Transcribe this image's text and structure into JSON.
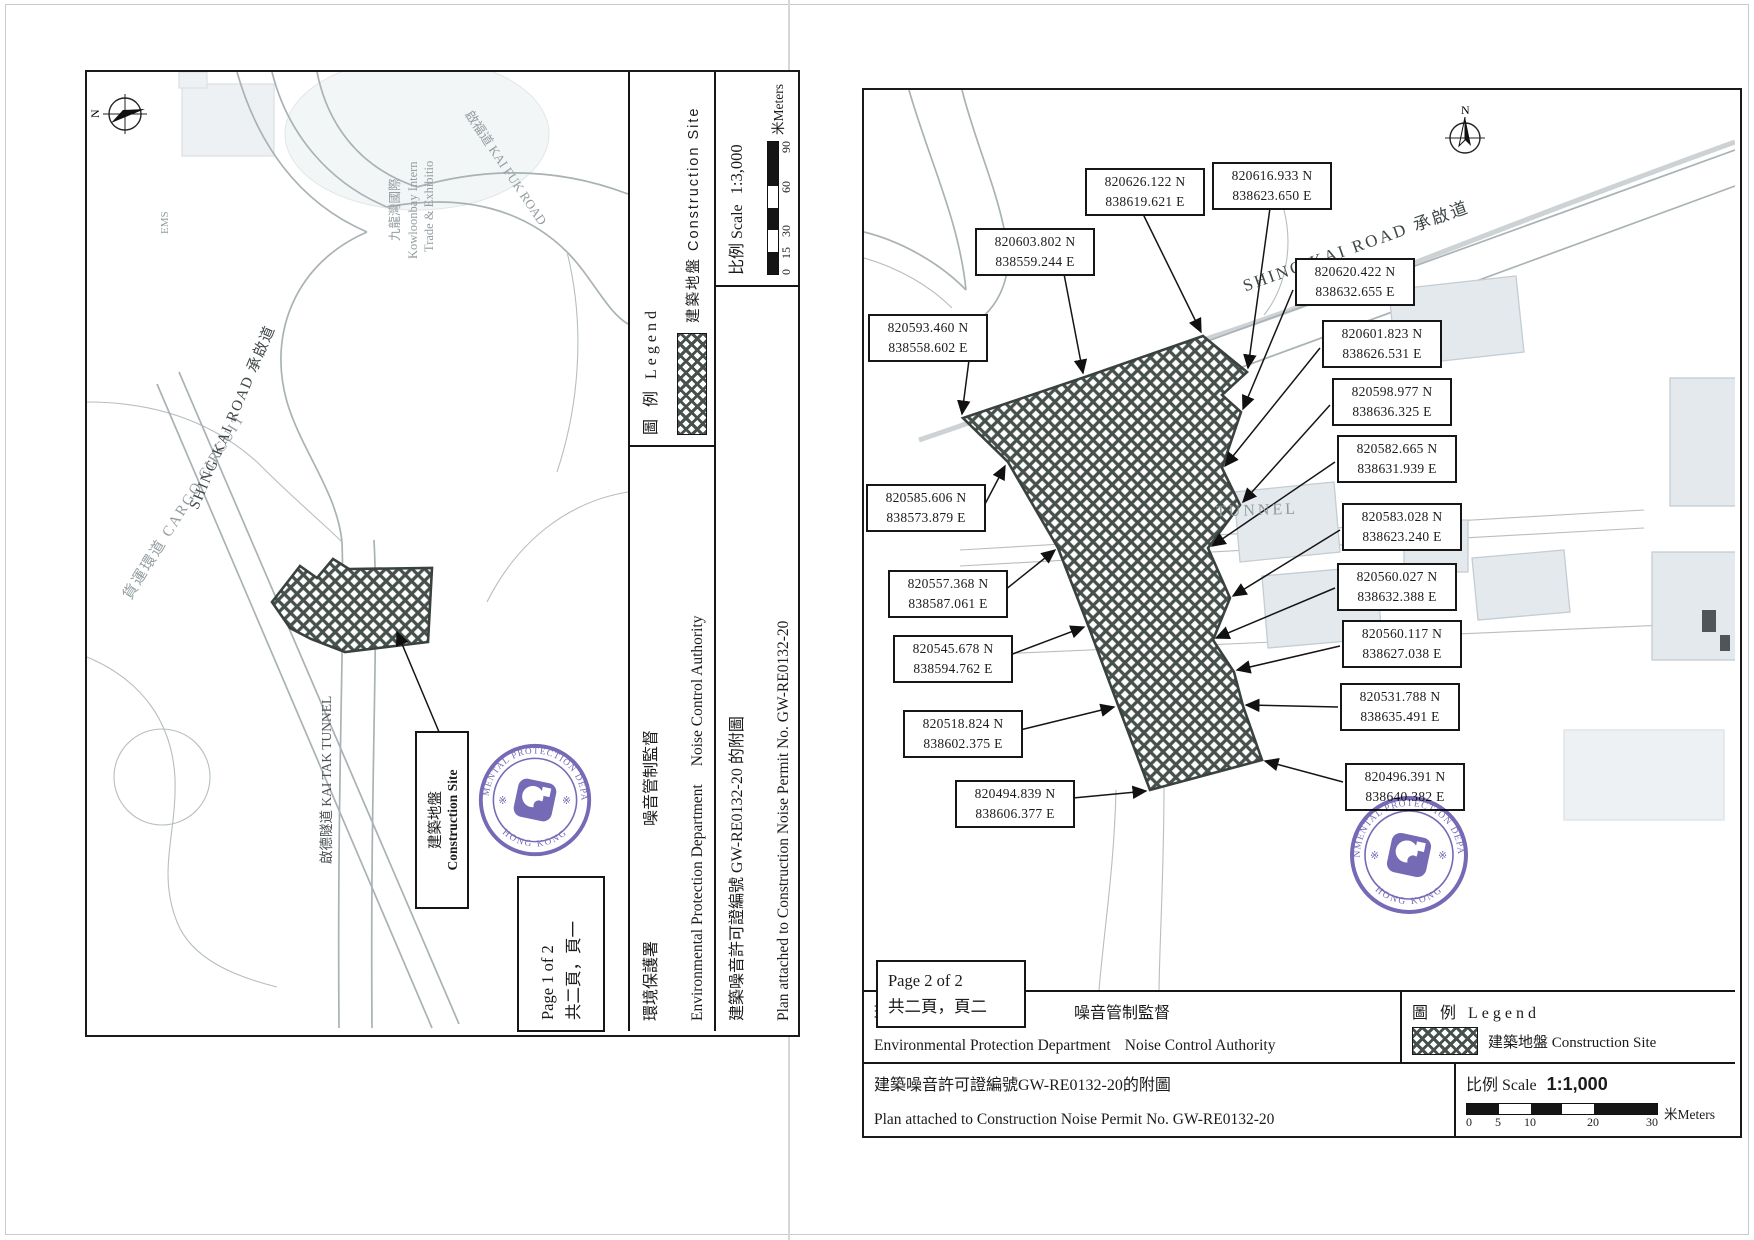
{
  "doc": {
    "permit_no": "GW-RE0132-20"
  },
  "titleblock": {
    "dept_zh": "環境保護署",
    "authority_zh": "噪音管制監督",
    "dept_en": "Environmental Protection Department",
    "authority_en": "Noise Control Authority",
    "legend_title": "圖 例  Legend",
    "legend_item": "建築地盤 Construction Site",
    "scale_label": "比例 Scale"
  },
  "stamp": {
    "ring_top": "ENVIRONMENTAL PROTECTION DEPARTMENT",
    "ring_bottom": "HONG KONG",
    "star": "※"
  },
  "page1": {
    "page_label_en": "Page 1 of 2",
    "page_label_zh": "共二頁，頁一",
    "scale_value": "1:3,000",
    "permit_line_zh": "建築噪音許可證編號  GW-RE0132-20  的附圖",
    "permit_line_en": "Plan attached to Construction Noise Permit No. GW-RE0132-20",
    "meters_label": "米Meters",
    "scalebar_ticks": [
      "0",
      "15",
      "30",
      "60",
      "90"
    ],
    "callout_zh": "建築地盤",
    "callout_en": "Construction Site",
    "map_labels": {
      "north": "N",
      "shing_kai_road": "SHING KAI ROAD 承啟道",
      "kai_tak_tunnel": "啟德隧道 KAI TAK TUNNEL",
      "cargo_circuit": "貨運環道 CARGO CIRCUIT",
      "kai_fuk_road": "啟福道 KAI FUK ROAD",
      "kowloonbay_zh": "九龍灣國際",
      "kowloonbay_en1": "Kowloonbay Intern",
      "kowloonbay_en2": "Trade & Exhibitio",
      "ems": "EMS"
    }
  },
  "page2": {
    "page_label_en": "Page 2 of 2",
    "page_label_zh": "共二頁，頁二",
    "scale_value": "1:1,000",
    "permit_line_zh": "建築噪音許可證編號GW-RE0132-20的附圖",
    "permit_line_en": "Plan attached to Construction Noise Permit No. GW-RE0132-20",
    "meters_label": "米Meters",
    "scalebar_ticks": [
      "0",
      "5",
      "10",
      "20",
      "30"
    ],
    "map_labels": {
      "north": "N",
      "shing_kai_road": "SHING KAI ROAD 承啟道",
      "tunnel": "TUNNEL",
      "ts": "TS"
    },
    "coords": [
      {
        "n": "820603.802 N",
        "e": "838559.244 E"
      },
      {
        "n": "820593.460 N",
        "e": "838558.602 E"
      },
      {
        "n": "820585.606 N",
        "e": "838573.879 E"
      },
      {
        "n": "820557.368 N",
        "e": "838587.061 E"
      },
      {
        "n": "820545.678 N",
        "e": "838594.762 E"
      },
      {
        "n": "820518.824 N",
        "e": "838602.375 E"
      },
      {
        "n": "820494.839 N",
        "e": "838606.377 E"
      },
      {
        "n": "820626.122 N",
        "e": "838619.621 E"
      },
      {
        "n": "820616.933 N",
        "e": "838623.650 E"
      },
      {
        "n": "820620.422 N",
        "e": "838632.655 E"
      },
      {
        "n": "820601.823 N",
        "e": "838626.531 E"
      },
      {
        "n": "820598.977 N",
        "e": "838636.325 E"
      },
      {
        "n": "820582.665 N",
        "e": "838631.939 E"
      },
      {
        "n": "820583.028 N",
        "e": "838623.240 E"
      },
      {
        "n": "820560.027 N",
        "e": "838632.388 E"
      },
      {
        "n": "820560.117 N",
        "e": "838627.038 E"
      },
      {
        "n": "820531.788 N",
        "e": "838635.491 E"
      },
      {
        "n": "820496.391 N",
        "e": "838640.382 E"
      }
    ]
  }
}
